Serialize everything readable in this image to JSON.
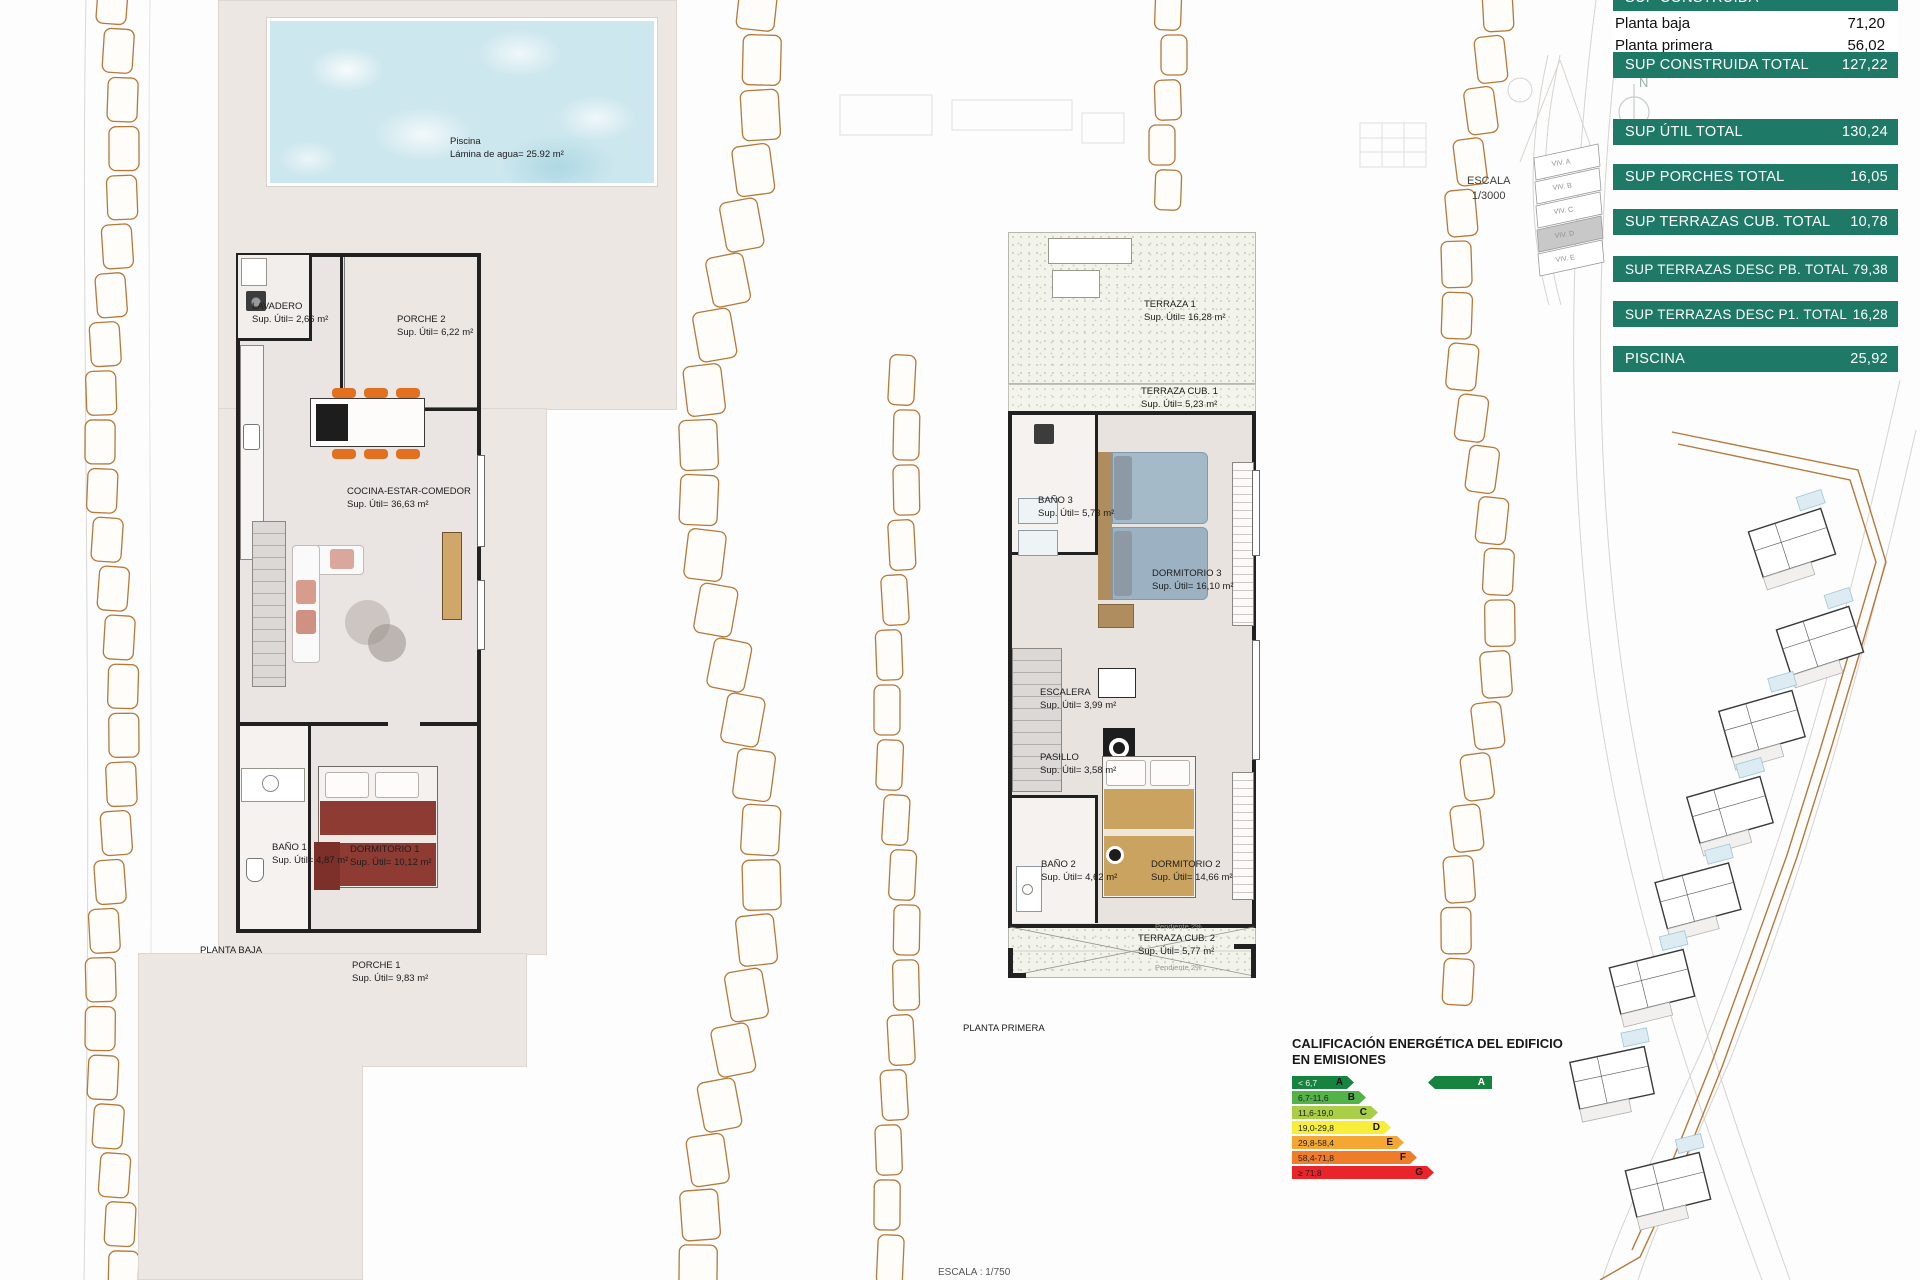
{
  "table": {
    "accent_color": "#1e7a67",
    "header": {
      "label": "SUP CONSTRUIDA"
    },
    "rows": [
      {
        "label": "Planta baja",
        "value": "71,20"
      },
      {
        "label": "Planta primera",
        "value": "56,02"
      }
    ],
    "totals": [
      {
        "label": "SUP CONSTRUIDA TOTAL",
        "value": "127,22"
      },
      {
        "label": "SUP ÚTIL TOTAL",
        "value": "130,24"
      },
      {
        "label": "SUP PORCHES TOTAL",
        "value": "16,05"
      },
      {
        "label": "SUP TERRAZAS CUB. TOTAL",
        "value": "10,78"
      },
      {
        "label": "SUP TERRAZAS DESC PB. TOTAL",
        "value": "79,38"
      },
      {
        "label": "SUP TERRAZAS DESC P1. TOTAL",
        "value": "16,28"
      },
      {
        "label": "PISCINA",
        "value": "25,92"
      }
    ]
  },
  "ground_floor": {
    "title": "PLANTA BAJA",
    "pool": {
      "name": "Piscina",
      "area": "Lámina de agua= 25.92 m²"
    },
    "rooms": [
      {
        "name": "LAVADERO",
        "area": "Sup. Útil= 2,66 m²"
      },
      {
        "name": "PORCHE 2",
        "area": "Sup. Útil= 6,22 m²"
      },
      {
        "name": "COCINA-ESTAR-COMEDOR",
        "area": "Sup. Útil= 36,63 m²"
      },
      {
        "name": "BAÑO 1",
        "area": "Sup. Útil= 4,87 m²"
      },
      {
        "name": "DORMITORIO 1",
        "area": "Sup. Útil= 10,12 m²"
      },
      {
        "name": "PORCHE 1",
        "area": "Sup. Útil= 9,83 m²"
      }
    ]
  },
  "first_floor": {
    "title": "PLANTA PRIMERA",
    "slope_note": "Pendiente 2%",
    "rooms": [
      {
        "name": "TERRAZA  1",
        "area": "Sup. Útil= 16,28 m²"
      },
      {
        "name": "TERRAZA CUB.  1",
        "area": "Sup. Útil= 5,23 m²"
      },
      {
        "name": "BAÑO 3",
        "area": "Sup. Útil= 5,73 m²"
      },
      {
        "name": "DORMITORIO 3",
        "area": "Sup. Útil= 16,10 m²"
      },
      {
        "name": "ESCALERA",
        "area": "Sup. Útil= 3,99 m²"
      },
      {
        "name": "PASILLO",
        "area": "Sup. Útil= 3,58 m²"
      },
      {
        "name": "BAÑO 2",
        "area": "Sup. Útil= 4,62 m²"
      },
      {
        "name": "DORMITORIO 2",
        "area": "Sup. Útil= 14,66 m²"
      },
      {
        "name": "TERRAZA CUB.  2",
        "area": "Sup. Útil= 5,77 m²"
      }
    ]
  },
  "site": {
    "scale_label": "ESCALA",
    "scale_value": "1/3000",
    "bottom_scale": "ESCALA : 1/750",
    "north_label": "N",
    "key_parcels": [
      "VIV. A",
      "VIV. B",
      "VIV. C",
      "VIV. D",
      "VIV. E"
    ],
    "highlighted_parcel": "VIV. D"
  },
  "energy": {
    "title_line1": "CALIFICACIÓN ENERGÉTICA DEL EDIFICIO",
    "title_line2": "EN EMISIONES",
    "bands": [
      {
        "range": "< 6,7",
        "letter": "A",
        "color": "#16843e"
      },
      {
        "range": "6,7-11,6",
        "letter": "B",
        "color": "#53b348"
      },
      {
        "range": "11,6-19,0",
        "letter": "C",
        "color": "#a8cf45"
      },
      {
        "range": "19,0-29,8",
        "letter": "D",
        "color": "#f6ee38"
      },
      {
        "range": "29,8-58,4",
        "letter": "E",
        "color": "#f5a733"
      },
      {
        "range": "58,4-71,8",
        "letter": "F",
        "color": "#ef7c29"
      },
      {
        "range": "≥ 71,8",
        "letter": "G",
        "color": "#e9252b"
      }
    ],
    "rating": {
      "letter": "A",
      "color": "#16843e"
    }
  }
}
